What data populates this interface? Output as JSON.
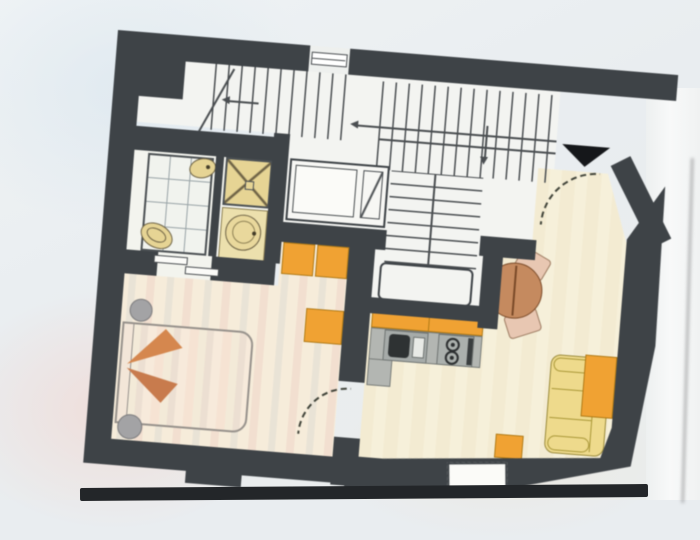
{
  "title": "Photographed apartment floor plan drawing (no text labels visible)",
  "palette": {
    "wall": "#3e4347",
    "line": "#4a4e51",
    "stairFloor": "#f3f4f1",
    "bathFloor": "#f3f4ee",
    "cream": "#f6f0da",
    "creamB": "#f3ebd2",
    "bedroomStripeA": "#f6ecda",
    "bedroomStripeB": "#f2dfd0",
    "bedroomStripeC": "#e9e3d6",
    "fixture": "#e6d494",
    "fixtureBorder": "#6b6043",
    "fixtureLight": "#ece0ad",
    "orange": "#f0a233",
    "orangeBorder": "#b07a16",
    "counter": "#b3b6b2",
    "counterBorder": "#787c79",
    "sinkDark": "#2e3233",
    "sofa": "#eeda8c",
    "sofaBorder": "#9a8a3a",
    "tableBrown": "#c58a5f",
    "tableBorder": "#7a4a28",
    "chair": "#e8c7b2",
    "chairBorder": "#9c7a60",
    "stool": "#a3a3a5",
    "stoolBorder": "#7b7b7d",
    "bedBorder": "#97928c",
    "bedTriangle1": "#d5874e",
    "bedTriangle2": "#c87b4d",
    "white": "#f7f7f4",
    "photoEdge": "#232629"
  },
  "plan": {
    "rotation_deg": 4.6,
    "style": "dark poché walls, colored furniture",
    "stairwell": {
      "flights": 3,
      "direction_arrows": 3,
      "landing": true,
      "window_in_top_wall": true,
      "elevator": {
        "cab": true,
        "diagonal_door_slot": true
      }
    },
    "entrance": {
      "marker": "solid black triangle",
      "door_swing": "dashed quarter-circle arc"
    },
    "rooms": [
      {
        "id": "bathroom",
        "fixtures": [
          "tiled bathtub",
          "shower square with X",
          "round washbasin",
          "toilet",
          "bidet"
        ],
        "door": "sliding door symbol"
      },
      {
        "id": "bedroom",
        "floor": "pastel striped",
        "furniture": [
          "double bed with orange throw triangles",
          "round stool x2",
          "orange wardrobe x3"
        ],
        "door": "dashed quarter-circle swing to living room"
      },
      {
        "id": "kitchen",
        "furniture": [
          "orange upper cabinet band",
          "gray counter",
          "sink with drainer",
          "two-burner hob"
        ]
      },
      {
        "id": "living-dining",
        "furniture": [
          "round dining table",
          "chair x2",
          "yellow three-part sofa",
          "orange sideboard",
          "orange side table"
        ],
        "openings": [
          "entry door",
          "balcony/window bay in bottom wall"
        ]
      }
    ]
  },
  "photo": {
    "background": "pale blue-gray with soft pink and blue tints",
    "bottom_edge": "dark horizontal strip",
    "right_margin": "white vertical band with gray streak"
  }
}
